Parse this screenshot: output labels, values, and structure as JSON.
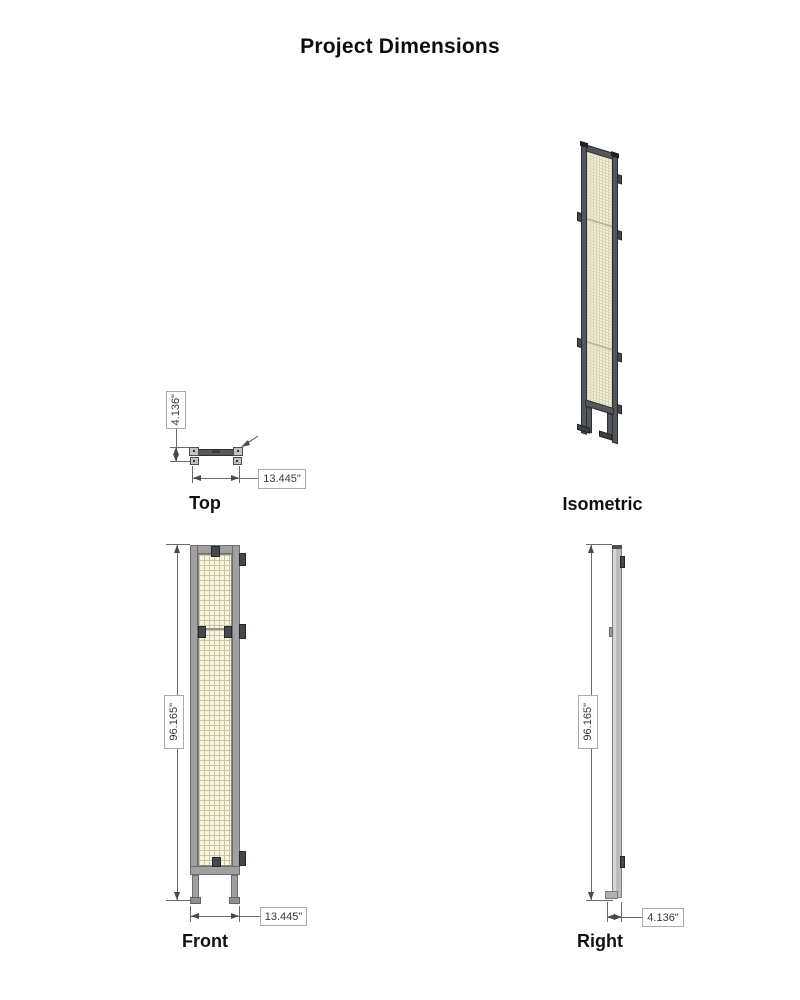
{
  "page": {
    "title": "Project Dimensions"
  },
  "colors": {
    "frame_gray": "#a0a0a0",
    "frame_dark": "#53575b",
    "mesh_fill": "#f7f4e1",
    "mesh_grid": "#c9c5a0",
    "clip_dark": "#45484c",
    "dim_line": "#6b6b6b",
    "dim_text": "#3a3a3a",
    "box_border": "#ababab"
  },
  "views": {
    "top": {
      "label": "Top",
      "depth": "4.136\"",
      "width": "13.445\""
    },
    "isometric": {
      "label": "Isometric"
    },
    "front": {
      "label": "Front",
      "height": "96.165\"",
      "width": "13.445\""
    },
    "right": {
      "label": "Right",
      "height": "96.165\"",
      "depth": "4.136\""
    }
  }
}
